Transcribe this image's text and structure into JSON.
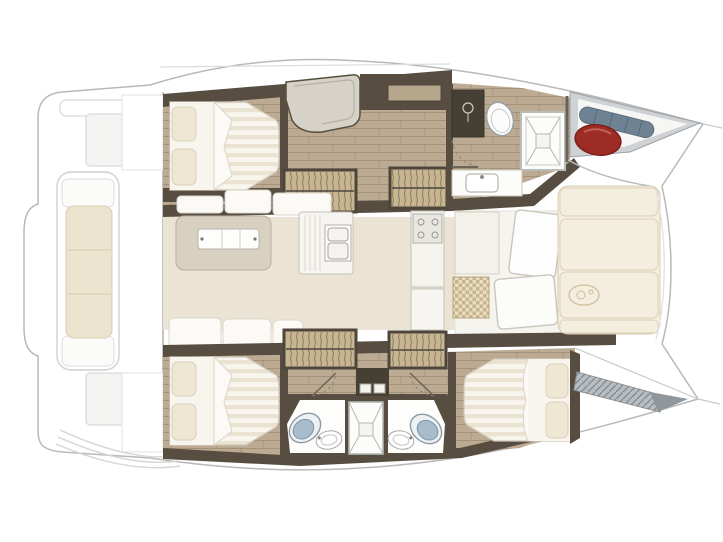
{
  "meta": {
    "title": "Catamaran deck and accommodation floor plan, bow pointing right",
    "visible_text": "none"
  },
  "palette": {
    "outline": "#b9b9b9",
    "outline_soft": "#d5d5d3",
    "deck_white": "#ffffff",
    "deck_panel": "#f4f4f2",
    "wood_floor": "#bcab92",
    "wood_line": "#9c8b72",
    "wall_dark": "#574e41",
    "wall_deep": "#453f34",
    "cabinet_tan": "#b7a78c",
    "stairs_fill": "#c8b692",
    "salon_floor": "#ebe4d5",
    "salon_front": "#f6f4ee",
    "island_fill": "#d8d1c2",
    "mattress_white": "#f7f5ee",
    "mattress_stripe": "#ebe3d1",
    "pillow": "#eee7d4",
    "cushion": "#f4eede",
    "cushion_line": "#d9cfb4",
    "bench_cushion": "#ede4cf",
    "fixture_white": "#fcfcfa",
    "fixture_line": "#a9aba6",
    "toilet_lid": "#a9bccc",
    "checker_dark": "#c9b58b",
    "checker_light": "#e8dec6",
    "seat_gray": "#d6d2c8",
    "fender_red": "#9c2c24",
    "roll_gray": "#6f8293",
    "net_gray": "#b8bdc1",
    "locker_gray": "#cfd2d4"
  },
  "vessel": {
    "type": "sailing-catamaran-floor-plan",
    "areas": [
      {
        "id": "aft-deck",
        "label": "Aft deck / transom",
        "features": [
          "transom-bench-cushion",
          "swim-steps",
          "deck-hatches"
        ]
      },
      {
        "id": "salon",
        "label": "Salon & cockpit",
        "features": [
          "island-table",
          "bench-cushions",
          "galley-twin-sinks",
          "stove",
          "checkered-mat",
          "folding-front-doors"
        ]
      },
      {
        "id": "port-hull",
        "label": "Port hull (top)",
        "features": [
          "aft-double-berth",
          "corner-seat",
          "companionway-steps",
          "wardrobe-steps",
          "toilet",
          "shower-cabin",
          "washbasin",
          "bow-locker-red-fender",
          "bow-locker-gray-roll"
        ]
      },
      {
        "id": "starboard-hull",
        "label": "Starboard hull (bottom)",
        "features": [
          "aft-double-berth",
          "forward-double-berth",
          "companionway-steps",
          "wardrobe-steps",
          "twin-bathrooms",
          "central-shower",
          "two-toilets",
          "two-washbasins",
          "bow-net-step"
        ]
      },
      {
        "id": "forward-cockpit",
        "label": "Forward cockpit lounge",
        "features": [
          "sunbed-cushions",
          "emblem"
        ]
      }
    ],
    "counts": {
      "double_berths": 3,
      "toilets": 3,
      "showers": 2,
      "washbasins": 3,
      "companionway_stairs": 4
    }
  }
}
